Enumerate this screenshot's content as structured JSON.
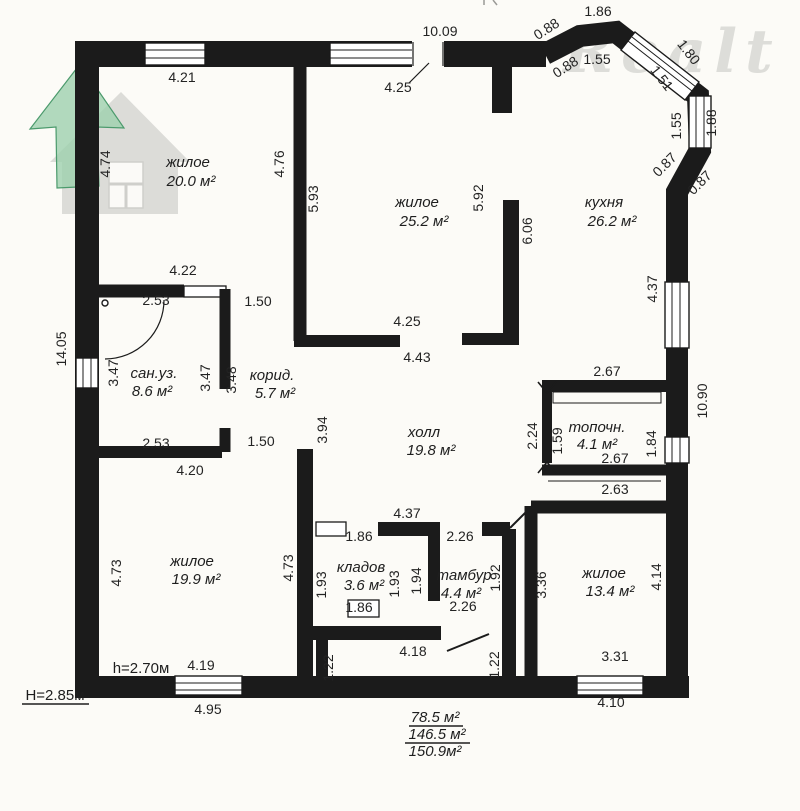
{
  "watermark": {
    "brand": "Realt"
  },
  "colors": {
    "ink": "#1b1b1b",
    "bg": "#fcfbf7",
    "logo_green": "#9ed1ae",
    "logo_green_edge": "#4b9a6c",
    "logo_gray": "#dcdcd8",
    "watermark_gray": "#d8d8d4"
  },
  "rooms": [
    {
      "name": "жилое",
      "area": "20.0 м²",
      "x": 188,
      "y": 167,
      "ax": 191,
      "ay": 186
    },
    {
      "name": "жилое",
      "area": "25.2 м²",
      "x": 417,
      "y": 207,
      "ax": 424,
      "ay": 226
    },
    {
      "name": "кухня",
      "area": "26.2 м²",
      "x": 604,
      "y": 207,
      "ax": 612,
      "ay": 226
    },
    {
      "name": "сан.уз.",
      "area": "8.6 м²",
      "x": 154,
      "y": 378,
      "ax": 152,
      "ay": 396
    },
    {
      "name": "корид.",
      "area": "5.7 м²",
      "x": 272,
      "y": 380,
      "ax": 275,
      "ay": 398
    },
    {
      "name": "холл",
      "area": "19.8 м²",
      "x": 424,
      "y": 437,
      "ax": 431,
      "ay": 455
    },
    {
      "name": "топочн.",
      "area": "4.1 м²",
      "x": 597,
      "y": 432,
      "ax": 597,
      "ay": 449
    },
    {
      "name": "кладов",
      "area": "3.6 м²",
      "x": 361,
      "y": 572,
      "ax": 364,
      "ay": 590
    },
    {
      "name": "тамбур",
      "area": "4.4 м²",
      "x": 464,
      "y": 580,
      "ax": 461,
      "ay": 598
    },
    {
      "name": "жилое",
      "area": "19.9 м²",
      "x": 192,
      "y": 566,
      "ax": 196,
      "ay": 584
    },
    {
      "name": "жилое",
      "area": "13.4 м²",
      "x": 604,
      "y": 578,
      "ax": 610,
      "ay": 596
    }
  ],
  "dims": [
    {
      "t": "10.09",
      "x": 440,
      "y": 36,
      "r": 0
    },
    {
      "t": "4.21",
      "x": 182,
      "y": 82,
      "r": 0
    },
    {
      "t": "4.25",
      "x": 398,
      "y": 92,
      "r": 0
    },
    {
      "t": "0.88",
      "x": 549,
      "y": 33,
      "r": -33
    },
    {
      "t": "0.88",
      "x": 568,
      "y": 71,
      "r": -33
    },
    {
      "t": "1.86",
      "x": 598,
      "y": 16,
      "r": 0
    },
    {
      "t": "1.55",
      "x": 597,
      "y": 64,
      "r": 0
    },
    {
      "t": "1.80",
      "x": 685,
      "y": 55,
      "r": 52
    },
    {
      "t": "1.51",
      "x": 658,
      "y": 81,
      "r": 52
    },
    {
      "t": "1.55",
      "x": 681,
      "y": 126,
      "r": -90
    },
    {
      "t": "1.88",
      "x": 716,
      "y": 123,
      "r": -90
    },
    {
      "t": "0.87",
      "x": 668,
      "y": 168,
      "r": -45
    },
    {
      "t": "0.87",
      "x": 703,
      "y": 186,
      "r": -45
    },
    {
      "t": "4.37",
      "x": 657,
      "y": 289,
      "r": -90
    },
    {
      "t": "10.90",
      "x": 707,
      "y": 401,
      "r": -90
    },
    {
      "t": "4.74",
      "x": 110,
      "y": 164,
      "r": -90
    },
    {
      "t": "4.76",
      "x": 284,
      "y": 164,
      "r": -90
    },
    {
      "t": "5.93",
      "x": 318,
      "y": 199,
      "r": -90
    },
    {
      "t": "5.92",
      "x": 483,
      "y": 198,
      "r": -90
    },
    {
      "t": "6.06",
      "x": 532,
      "y": 231,
      "r": -90
    },
    {
      "t": "14.05",
      "x": 66,
      "y": 349,
      "r": -90
    },
    {
      "t": "4.22",
      "x": 183,
      "y": 275,
      "r": 0
    },
    {
      "t": "2.53",
      "x": 156,
      "y": 305,
      "r": 0
    },
    {
      "t": "1.50",
      "x": 258,
      "y": 306,
      "r": 0
    },
    {
      "t": "3.47",
      "x": 118,
      "y": 373,
      "r": -90
    },
    {
      "t": "3.47",
      "x": 210,
      "y": 378,
      "r": -90
    },
    {
      "t": "3.48",
      "x": 236,
      "y": 380,
      "r": -90
    },
    {
      "t": "4.25",
      "x": 407,
      "y": 326,
      "r": 0
    },
    {
      "t": "4.43",
      "x": 417,
      "y": 362,
      "r": 0
    },
    {
      "t": "2.53",
      "x": 156,
      "y": 448,
      "r": 0
    },
    {
      "t": "1.50",
      "x": 261,
      "y": 446,
      "r": 0
    },
    {
      "t": "4.20",
      "x": 190,
      "y": 475,
      "r": 0
    },
    {
      "t": "3.94",
      "x": 327,
      "y": 430,
      "r": -90
    },
    {
      "t": "2.67",
      "x": 607,
      "y": 376,
      "r": 0
    },
    {
      "t": "2.24",
      "x": 537,
      "y": 436,
      "r": -90
    },
    {
      "t": "1.59",
      "x": 562,
      "y": 441,
      "r": -90
    },
    {
      "t": "1.84",
      "x": 656,
      "y": 444,
      "r": -90
    },
    {
      "t": "2.67",
      "x": 615,
      "y": 463,
      "r": 0
    },
    {
      "t": "2.63",
      "x": 615,
      "y": 494,
      "r": 0
    },
    {
      "t": "4.37",
      "x": 407,
      "y": 518,
      "r": 0
    },
    {
      "t": "1.86",
      "x": 359,
      "y": 541,
      "r": 0
    },
    {
      "t": "2.26",
      "x": 460,
      "y": 541,
      "r": 0
    },
    {
      "t": "4.73",
      "x": 121,
      "y": 573,
      "r": -90
    },
    {
      "t": "4.73",
      "x": 293,
      "y": 568,
      "r": -90
    },
    {
      "t": "1.93",
      "x": 326,
      "y": 585,
      "r": -90
    },
    {
      "t": "1.93",
      "x": 399,
      "y": 584,
      "r": -90
    },
    {
      "t": "1.94",
      "x": 421,
      "y": 581,
      "r": -90
    },
    {
      "t": "1.92",
      "x": 500,
      "y": 578,
      "r": -90
    },
    {
      "t": "3.36",
      "x": 546,
      "y": 585,
      "r": -90
    },
    {
      "t": "4.14",
      "x": 661,
      "y": 577,
      "r": -90
    },
    {
      "t": "1.86",
      "x": 359,
      "y": 612,
      "r": 0
    },
    {
      "t": "2.26",
      "x": 463,
      "y": 611,
      "r": 0
    },
    {
      "t": "4.18",
      "x": 413,
      "y": 656,
      "r": 0
    },
    {
      "t": "1.22",
      "x": 333,
      "y": 668,
      "r": -90
    },
    {
      "t": "1.22",
      "x": 499,
      "y": 665,
      "r": -90
    },
    {
      "t": "4.19",
      "x": 201,
      "y": 670,
      "r": 0
    },
    {
      "t": "3.31",
      "x": 615,
      "y": 661,
      "r": 0
    },
    {
      "t": "4.95",
      "x": 208,
      "y": 714,
      "r": 0
    },
    {
      "t": "4.10",
      "x": 611,
      "y": 707,
      "r": 0
    }
  ],
  "notes": [
    {
      "t": "h=2.70м",
      "x": 141,
      "y": 673
    },
    {
      "t": "Н=2.85м",
      "x": 55,
      "y": 700,
      "u": [
        22,
        704,
        89,
        704
      ]
    }
  ],
  "totals": [
    {
      "t": "78.5 м²",
      "x": 435,
      "y": 722,
      "u": [
        409,
        726,
        463,
        726
      ]
    },
    {
      "t": "146.5 м²",
      "x": 437,
      "y": 739,
      "u": [
        405,
        743,
        470,
        743
      ]
    },
    {
      "t": "150.9м²",
      "x": 435,
      "y": 756
    }
  ]
}
